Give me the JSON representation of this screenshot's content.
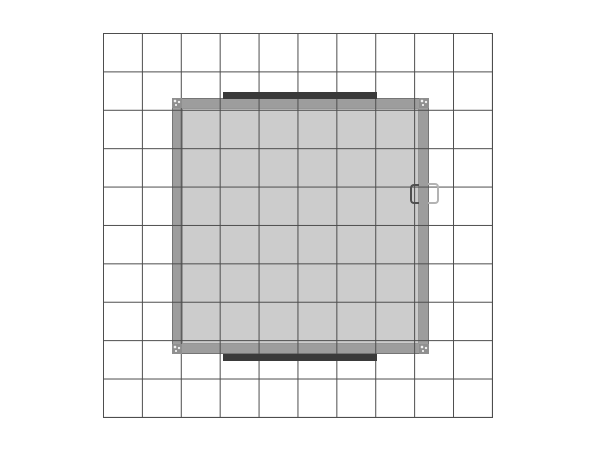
{
  "canvas": {
    "background_color": "#ffffff",
    "width_px": 600,
    "height_px": 450
  },
  "grid": {
    "rows": 10,
    "columns": 10,
    "line_color": "#4d4d4d"
  },
  "structure": {
    "frame_color": "#9d9d9d",
    "frame_edge_color": "#757575",
    "interior_color": "#cccccc",
    "interior_edge_color": "#969696",
    "accent_bar_color": "#3a3a3a",
    "accent_bar_count": 2,
    "corner_connector_color": "#8f8f8f",
    "corner_connector_count": 4,
    "corner_dot_color": "#f2f2f2",
    "inner_handle_color": "#4f4f4f",
    "outer_handle_color": "#b3b3b3"
  }
}
